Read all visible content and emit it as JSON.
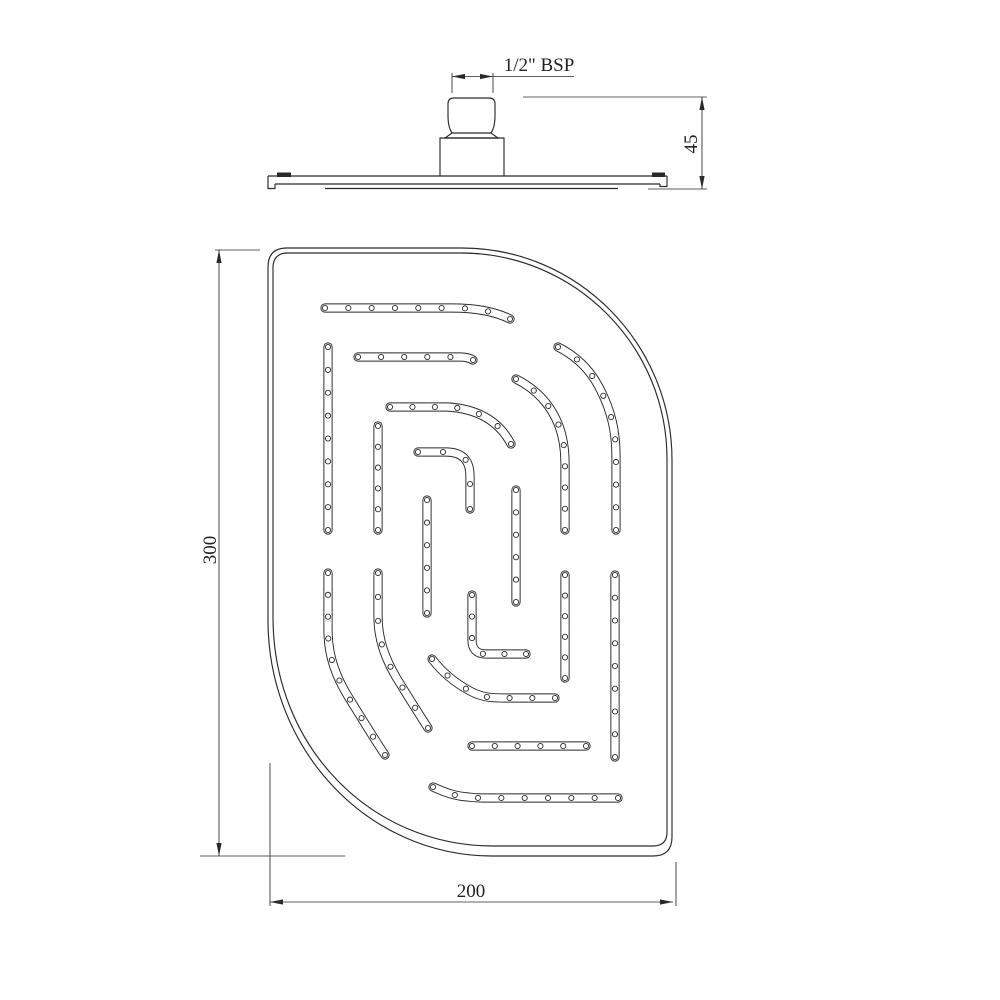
{
  "labels": {
    "bsp": "1/2\" BSP",
    "height": "45",
    "length": "300",
    "width": "200"
  },
  "colors": {
    "line": "#2a2a2a",
    "background": "#ffffff",
    "hole_fill": "#ffffff"
  },
  "line_weights": {
    "object": 1.15,
    "dimension": 0.85,
    "hole": 0.9
  },
  "side_view": {
    "name": "side-elevation-of-shower-head",
    "outline_paths": [
      "M 268,176 H 667",
      "M 268,176 V 188.5 H 275 V 184",
      "M 275,184 H 660",
      "M 667,176 V 186.5 H 660 V 184",
      "M 325,188.5 H 618",
      "M 448,116 V 104 Q 448,98 454,98 H 489 Q 495,98 495,104 V 116 Q 495,127 491,133 L 452,133 Q 448,127 448,116 Z",
      "M 452,133 L 445,138 H 498 L 491,133",
      "M 440,176 V 138 H 504 V 176"
    ],
    "filled_marks": [
      [
        277,
        172.5,
        14,
        4.5
      ],
      [
        652,
        172.5,
        13,
        4.5
      ]
    ]
  },
  "plan_view": {
    "name": "plan-view-of-spray-face",
    "outline_outer": "M 287,248 H 462 C 578,248 672,344 672,460 V 837 Q 672,856 653,856 H 492 C 368,856 268,750 268,620 V 267 Q 268,248 287,248 Z",
    "outline_inner": "M 288,253 H 461 C 575,253 667,346 667,459 V 832 Q 667,846 653,846 H 493 C 371,846 273,747 273,617 V 268 Q 273,253 288,253 Z",
    "slot_outer_width": 9.2,
    "slot_inner_width": 7.3,
    "hole_radius": 2.6,
    "hole_spacing": 22.5,
    "slots": [
      "M 325,308 H 452 C 478,308 496,312 510,319",
      "M 358,357 H 460 Q 468,357 473,360",
      "M 390,407 H 448 C 478,409 499,421 511,444",
      "M 418,452 H 446 Q 470,452 470,476 V 509",
      "M 328,347 V 530",
      "M 378,426 V 530",
      "M 427,500 V 613",
      "M 516,490 V 602",
      "M 516,379 C 536,389 551,405 559,426 C 563,437 565,449 565,463 V 530",
      "M 558,347 C 576,356 591,370 601,391 C 611,411 616,431 616,456 V 530",
      "M 328,573 V 630 C 328,656 336,677 349,698 C 361,717 371,734 385,755",
      "M 378,573 V 616 C 378,639 385,658 396,677 C 407,695 417,711 428,728",
      "M 432,659 C 442,672 455,683 470,691 C 483,698 493,698 506,698 H 555",
      "M 472,595 V 640 Q 472,654 486,654 H 526",
      "M 472,746 H 586",
      "M 433,787 C 444,792 454,796 468,797 Q 475,798 483,798 H 618",
      "M 565,575 V 678",
      "M 615,575 V 757"
    ]
  },
  "dimension_graphics": {
    "lines": [
      [
        452,
        73,
        452,
        93
      ],
      [
        493,
        73,
        493,
        93
      ],
      [
        452,
        76.5,
        493,
        76.5
      ],
      [
        493,
        76.5,
        574,
        76.5
      ],
      [
        523,
        97,
        707,
        97
      ],
      [
        648,
        189,
        707,
        189
      ],
      [
        702,
        97,
        702,
        189
      ],
      [
        215,
        250,
        260,
        250
      ],
      [
        200,
        856,
        345,
        856
      ],
      [
        219,
        250,
        219,
        856
      ],
      [
        270,
        763,
        270,
        906
      ],
      [
        676,
        862,
        676,
        906
      ],
      [
        270,
        902,
        673,
        902
      ]
    ],
    "arrows": [
      [
        452,
        76.5,
        180
      ],
      [
        493,
        76.5,
        0
      ],
      [
        702,
        97,
        -90
      ],
      [
        702,
        189,
        90
      ],
      [
        219,
        250,
        -90
      ],
      [
        219,
        856,
        90
      ],
      [
        270,
        902,
        180
      ],
      [
        673,
        902,
        0
      ]
    ]
  }
}
